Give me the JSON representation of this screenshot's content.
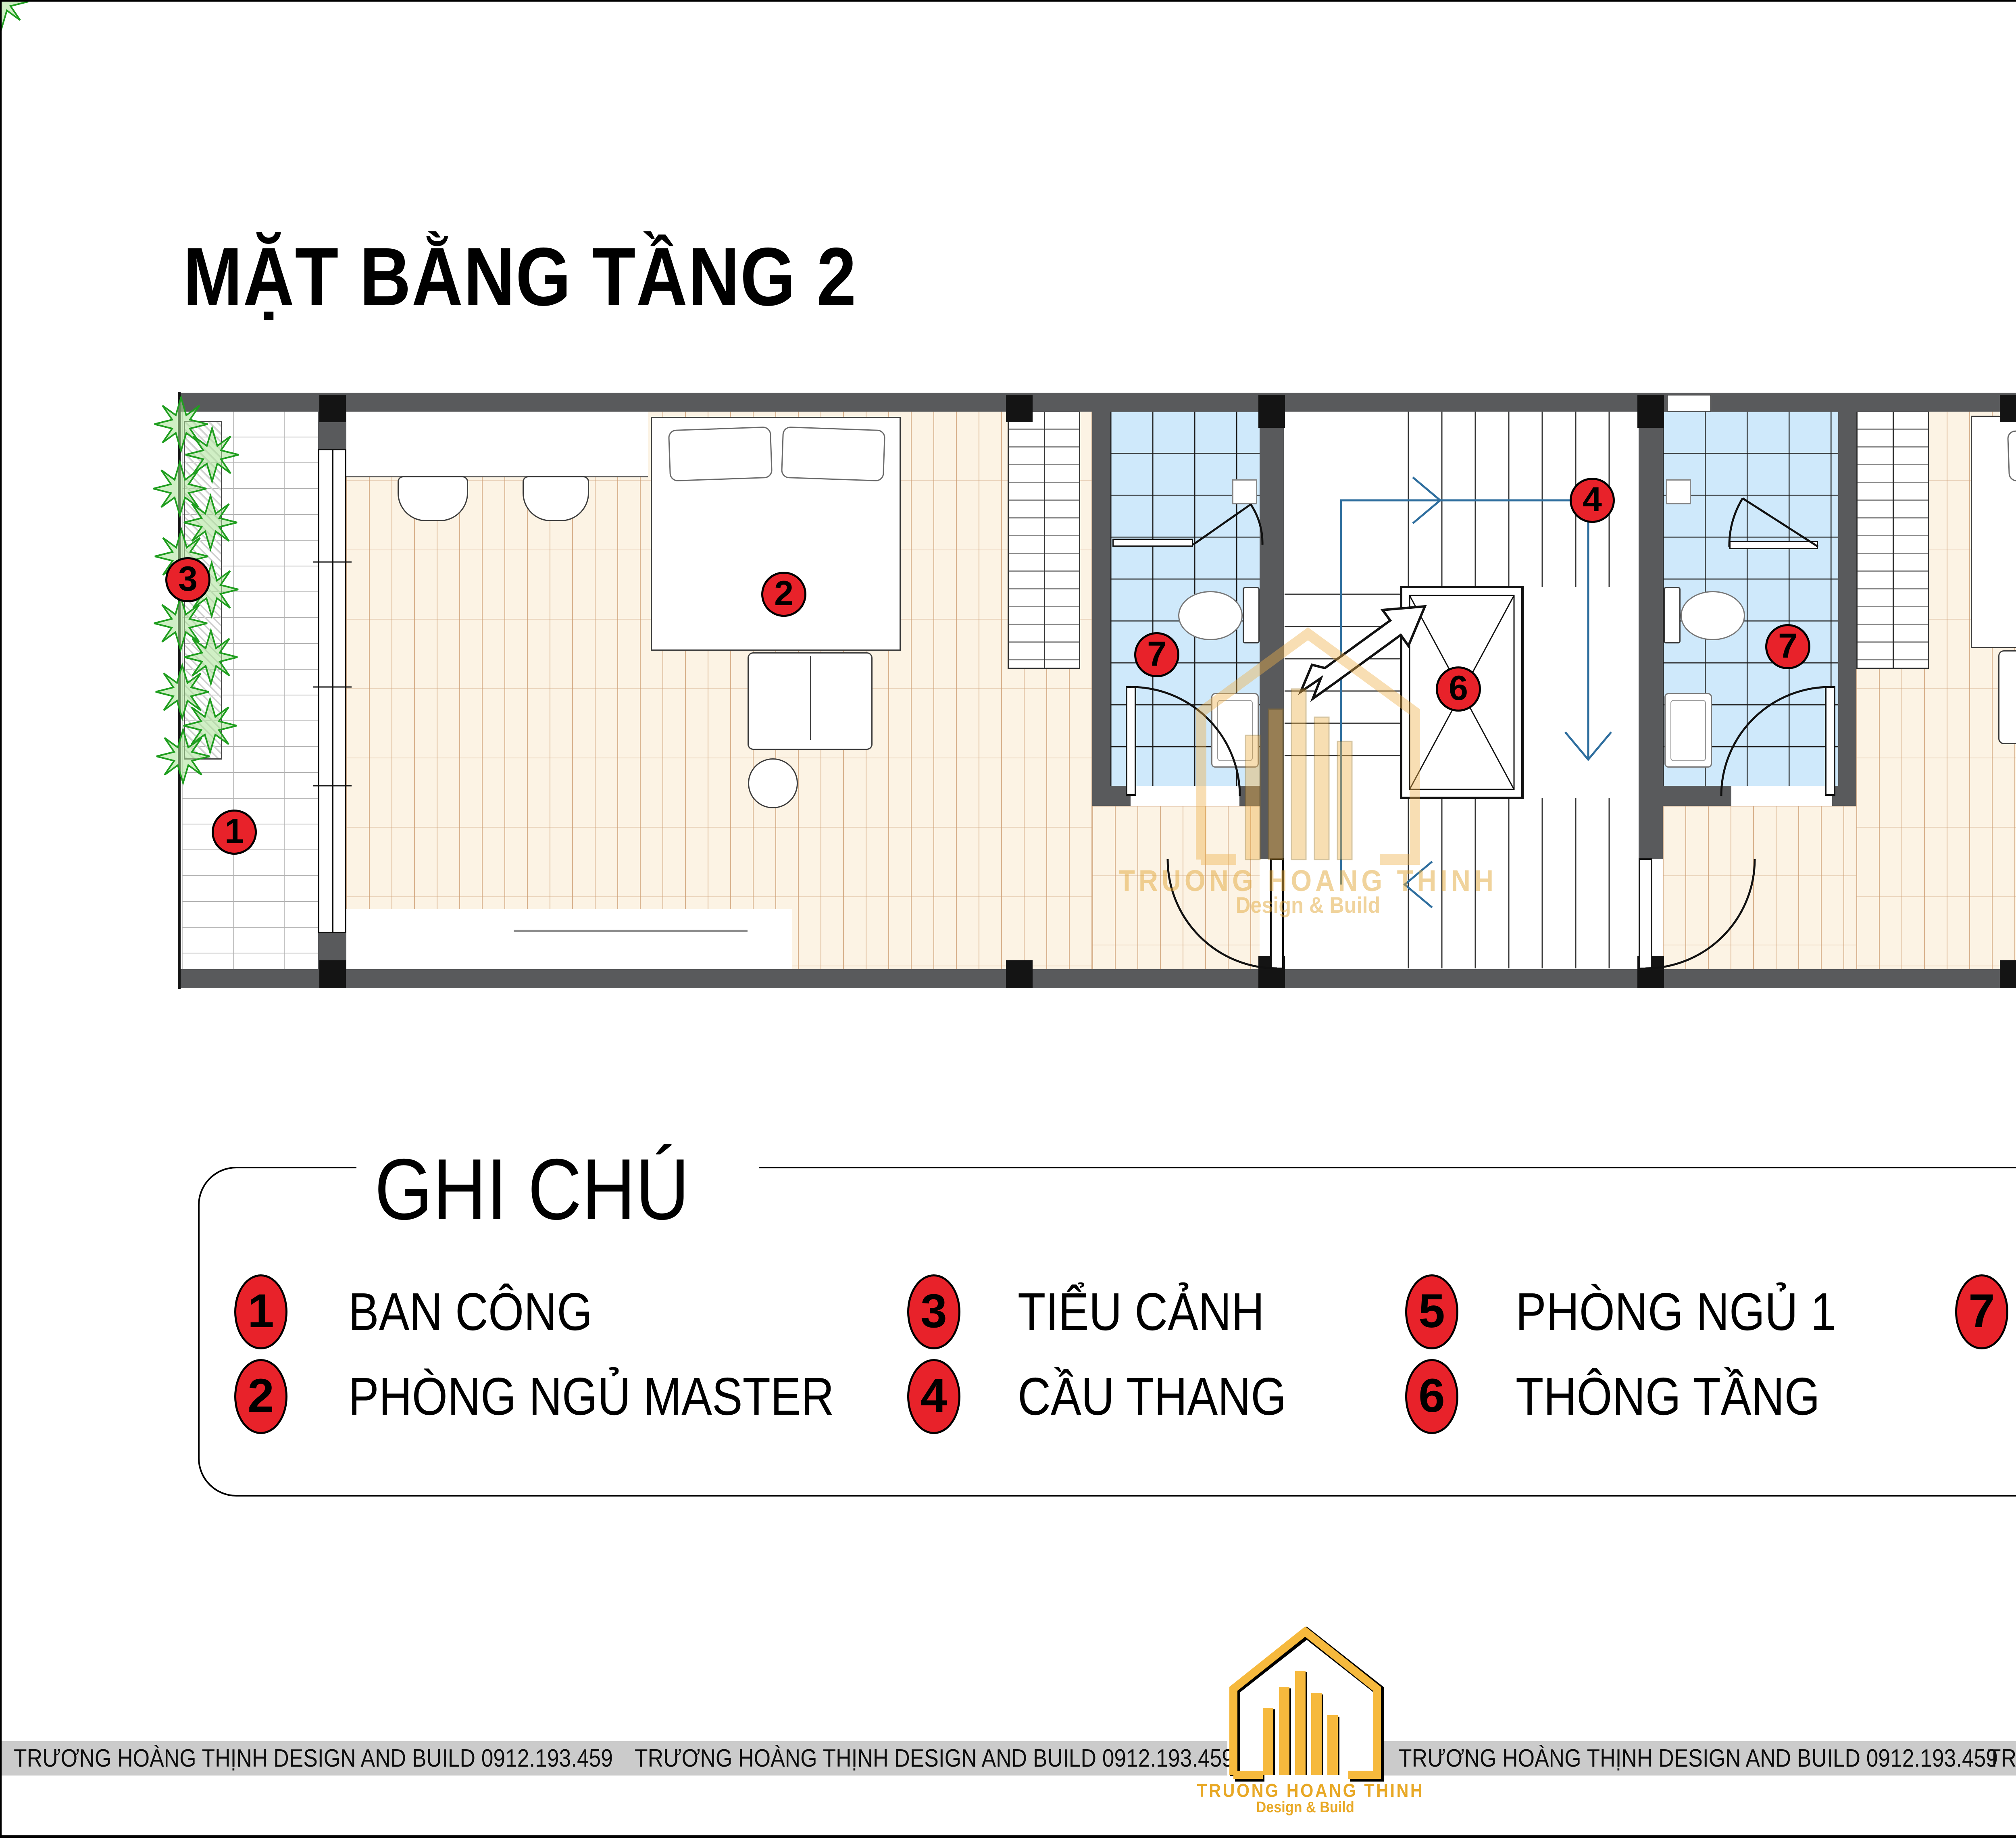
{
  "page": {
    "title": "MẶT BẰNG TẦNG 2"
  },
  "legend": {
    "title": "GHI CHÚ",
    "items": [
      {
        "n": "1",
        "label": "BAN CÔNG"
      },
      {
        "n": "2",
        "label": "PHÒNG NGỦ MASTER"
      },
      {
        "n": "3",
        "label": "TIỂU CẢNH"
      },
      {
        "n": "4",
        "label": "CẦU THANG"
      },
      {
        "n": "5",
        "label": "PHÒNG NGỦ 1"
      },
      {
        "n": "6",
        "label": "THÔNG TẦNG"
      },
      {
        "n": "7",
        "label": "PHÒNG VỆ SINH"
      }
    ]
  },
  "plan": {
    "markers": [
      {
        "n": "3",
        "room": "tieu-canh"
      },
      {
        "n": "1",
        "room": "ban-cong"
      },
      {
        "n": "2",
        "room": "phong-ngu-master"
      },
      {
        "n": "7",
        "room": "phong-ve-sinh-1"
      },
      {
        "n": "4",
        "room": "cau-thang"
      },
      {
        "n": "6",
        "room": "thong-tang"
      },
      {
        "n": "7",
        "room": "phong-ve-sinh-2"
      },
      {
        "n": "5",
        "room": "phong-ngu-1"
      }
    ]
  },
  "watermark": {
    "name": "TRUONG HOANG THINH",
    "tagline": "Design & Build"
  },
  "footer": {
    "segments": [
      "TRƯƠNG HOÀNG THỊNH DESIGN AND BUILD 0912.193.459",
      "TRƯƠNG HOÀNG THỊNH DESIGN AND BUILD 0912.193.459",
      "TRƯƠNG HOÀNG THỊNH DESIGN AND BUILD 0912.193.459",
      "TRƯƠNG HOÀNG THỊNH DESIGN AND BUILD 0912.193.459"
    ],
    "logo": {
      "name": "TRUONG HOANG THINH",
      "tagline": "Design & Build"
    }
  },
  "colors": {
    "marker_red": "#e8222a",
    "wall_gray": "#595a5c",
    "tile_blue": "#cfe9fb",
    "wood_cream": "#fcf3e4",
    "brand_gold": "#f2b648",
    "footer_bar_gray": "#cbcbcb",
    "stair_guide_blue": "#2e6e9e"
  }
}
